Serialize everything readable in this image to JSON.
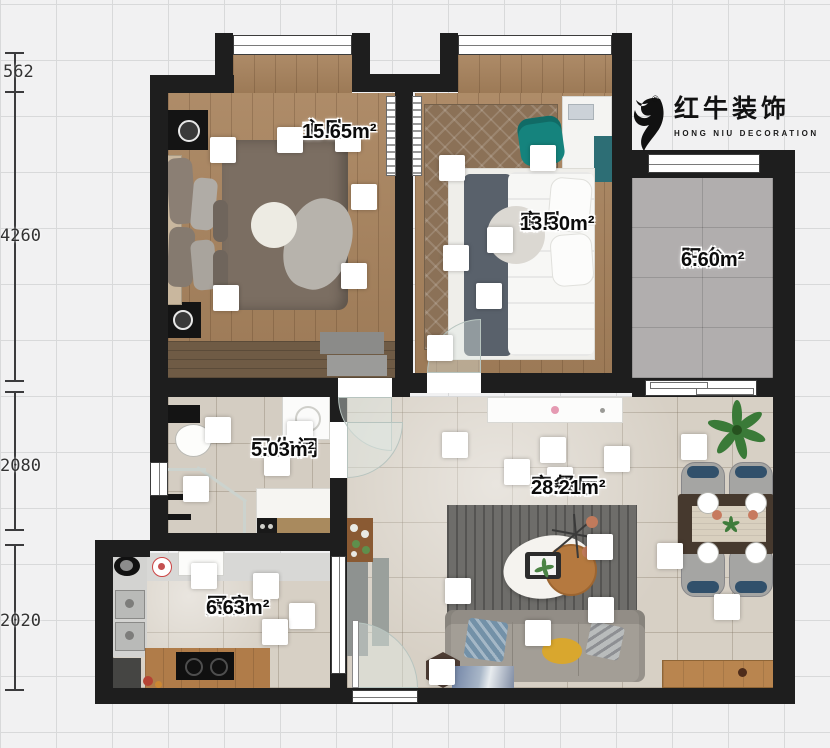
{
  "document": {
    "type": "floor-plan",
    "width": 830,
    "height": 748
  },
  "logo": {
    "brand": "红牛装饰",
    "subtitle": "HONG NIU DECORATION",
    "registered": "®",
    "icon": "bull-icon"
  },
  "dimensions": {
    "orientation": "vertical-left",
    "unit": "mm",
    "values": [
      "562",
      "4260",
      "2080",
      "2020"
    ]
  },
  "rooms": [
    {
      "id": "master-bedroom",
      "name": "主卧",
      "area": "15.65m²"
    },
    {
      "id": "guest-bedroom",
      "name": "客卧",
      "area": "13.30m²"
    },
    {
      "id": "balcony",
      "name": "阳台",
      "area": "6.60m²"
    },
    {
      "id": "bathroom",
      "name": "卫生间",
      "area": "5.03m²"
    },
    {
      "id": "living-dining",
      "name": "客餐厅",
      "area": "28.21m²"
    },
    {
      "id": "kitchen",
      "name": "厨房",
      "area": "6.63m²"
    }
  ],
  "icons": {
    "logo": "bull-icon",
    "light_marker": "ceiling-light",
    "plant": "potted-plant"
  },
  "palette": {
    "wall": "#1e1e1e",
    "wood_floor": "#a8835d",
    "tile_floor": "#d7d0c5",
    "balcony_floor": "#b1aeae",
    "accent_teal": "#15837d",
    "grid": "#d8d9da",
    "canvas": "#f1f1f2"
  }
}
